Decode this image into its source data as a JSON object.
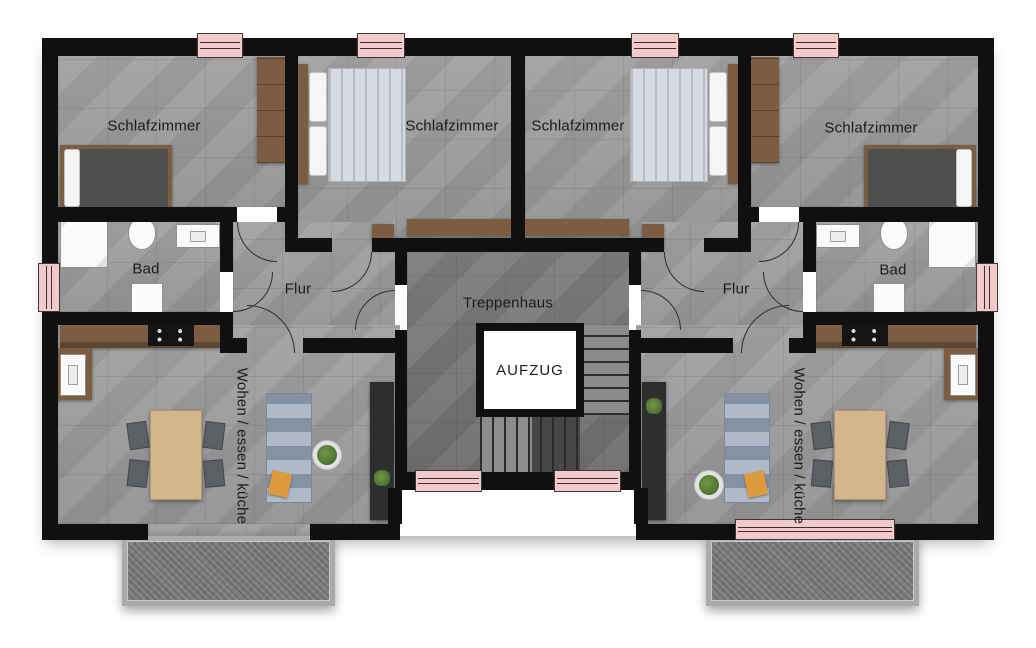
{
  "plan": {
    "rooms": {
      "bedroom_left_outer": "Schlafzimmer",
      "bedroom_left_inner": "Schlafzimmer",
      "bedroom_right_inner": "Schlafzimmer",
      "bedroom_right_outer": "Schlafzimmer",
      "bath_left": "Bad",
      "bath_right": "Bad",
      "hall_left": "Flur",
      "hall_right": "Flur",
      "stairwell": "Treppenhaus",
      "elevator": "AUFZUG",
      "living_left": "Wohen / essen / küche",
      "living_right": "Wohen / essen / küche"
    },
    "colors": {
      "wall": "#101010",
      "floor": "#9c9c9c",
      "stairwell_floor": "#757575",
      "window": "#f4c9ca",
      "wood": "#7d5d41",
      "table": "#d4b68c",
      "sofa": "#96a2b5",
      "accent_cushion": "#dd9a3e"
    }
  }
}
